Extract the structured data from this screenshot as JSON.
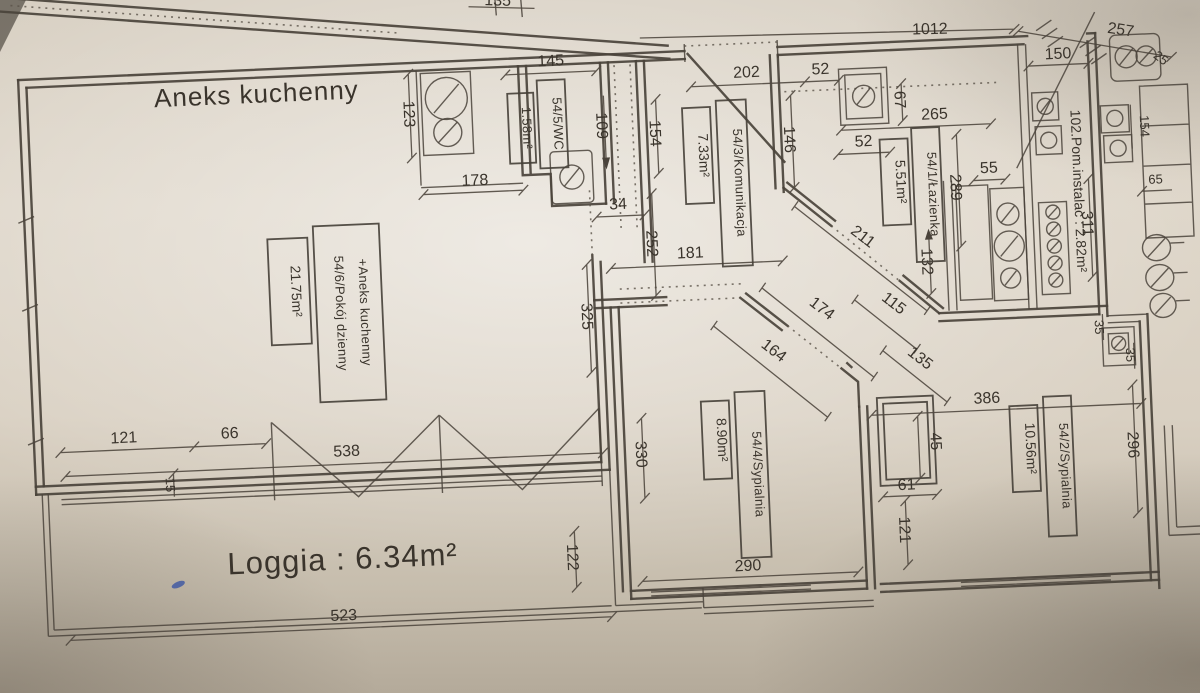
{
  "drawing": {
    "annotations": {
      "kitchen_annex": "Aneks kuchenny",
      "loggia": "Loggia : 6.34m²"
    },
    "rooms": [
      {
        "name": "54/6/Pokój dzienny",
        "name2": "+Aneks kuchenny",
        "area": "21.75m²"
      },
      {
        "name": "54/5/WC",
        "area": "1.58m²"
      },
      {
        "name": "54/3/Komunikacja",
        "area": "7.33m²"
      },
      {
        "name": "54/1/Łazienka",
        "area": "5.51m²"
      },
      {
        "name": "54/4/Sypialnia",
        "area": "8.90m²"
      },
      {
        "name": "54/2/Sypialnia",
        "area": "10.56m²"
      },
      {
        "name": "102.Pom.instalac : 2.82m²"
      }
    ],
    "dims": {
      "top_1012": "1012",
      "top_257": "257",
      "top_135": "135",
      "k_123": "123",
      "k_145": "145",
      "k_178": "178",
      "kom_109": "109",
      "kom_154": "154",
      "kom_34": "34",
      "kom_252": "252",
      "kom_325": "325",
      "kom_181": "181",
      "ent_202": "202",
      "ent_52": "52",
      "laz_52": "52",
      "laz_67": "67",
      "laz_265": "265",
      "laz_146": "146",
      "laz_289": "289",
      "laz_55": "55",
      "laz_132": "132",
      "laz_211": "211",
      "inst_150": "150",
      "inst_311": "311",
      "diag_174": "174",
      "diag_164": "164",
      "diag_115": "115",
      "diag_135": "135",
      "s4_330": "330",
      "s4_290": "290",
      "s4_61": "61",
      "s4_121": "121",
      "s4_45": "45",
      "s2_386": "386",
      "s2_296": "296",
      "s2_35a": "35",
      "s2_35b": "35",
      "log_121": "121",
      "log_66": "66",
      "log_538": "538",
      "log_15": "15",
      "log_523": "523",
      "log_122": "122",
      "nb_154": "154",
      "nb_65": "65",
      "nb_25": "25"
    }
  }
}
